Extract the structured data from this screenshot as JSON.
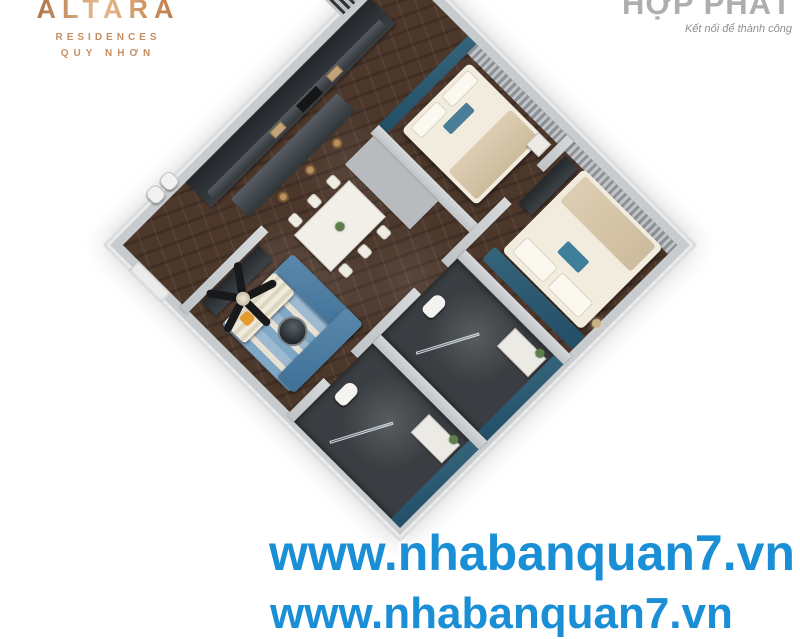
{
  "branding": {
    "altara": {
      "name": "ALTARA",
      "sub1": "RESIDENCES",
      "sub2": "QUY NHƠN",
      "gold_start": "#a5653b",
      "gold_end": "#e6bb90"
    },
    "hopphat": {
      "name": "HỢP PHÁT",
      "tagline": "Kết nối để thành công",
      "color": "#aeaeae"
    }
  },
  "watermark": {
    "line1": "www.nhabanquan7.vn",
    "line2_partial": "www.nhabanquan7.vn",
    "color": "#1b8fd6"
  },
  "floorplan": {
    "type": "3d-apartment-render",
    "orientation_deg": 45,
    "rooms": [
      "living-room",
      "dining-area",
      "kitchen",
      "bedroom-1",
      "bedroom-2",
      "bathroom-1",
      "bathroom-2",
      "hallway",
      "entry",
      "balcony"
    ],
    "colors": {
      "accent_teal": "#2a5a73",
      "floor_wood": "#4c372b",
      "sofa_blue": "#4e7ea6",
      "bathroom_dark": "#3a3d41",
      "wall_gray": "#c9ccce",
      "bed_cream": "#f2ecdf"
    }
  }
}
